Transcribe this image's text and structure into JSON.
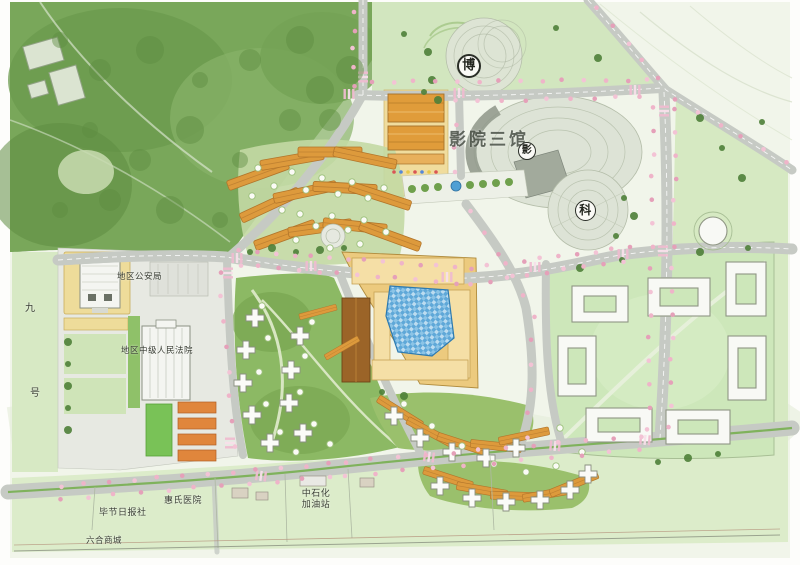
{
  "map": {
    "labels": {
      "museum_badge": "博",
      "cinema_complex": "影院三馆",
      "cinema_badge": "影",
      "science_badge": "科",
      "public_security_bureau": "地区公安局",
      "peoples_court": "地区中级人民法院",
      "road_name_char_top": "九",
      "road_name_char_bottom": "号",
      "newspaper_office": "毕节日报社",
      "hospital": "惠氏医院",
      "gas_station": {
        "line1": "中石化",
        "line2": "加油站"
      },
      "shopping_mall": "六合商城"
    },
    "colors": {
      "forest_green": "#79a75a",
      "lawn_green": "#cfe4bb",
      "park_green": "#8cb964",
      "superblock_green": "#cde7ba",
      "plaza_gray": "#dde3d6",
      "road_gray": "#c6cac4",
      "building_orange": "#dd9a3c",
      "mall_tan": "#ecca7e",
      "pool_blue": "#4f9fd4",
      "blossom_pink": "#efb4c9",
      "plot_yellow": "#eedc9a"
    }
  }
}
